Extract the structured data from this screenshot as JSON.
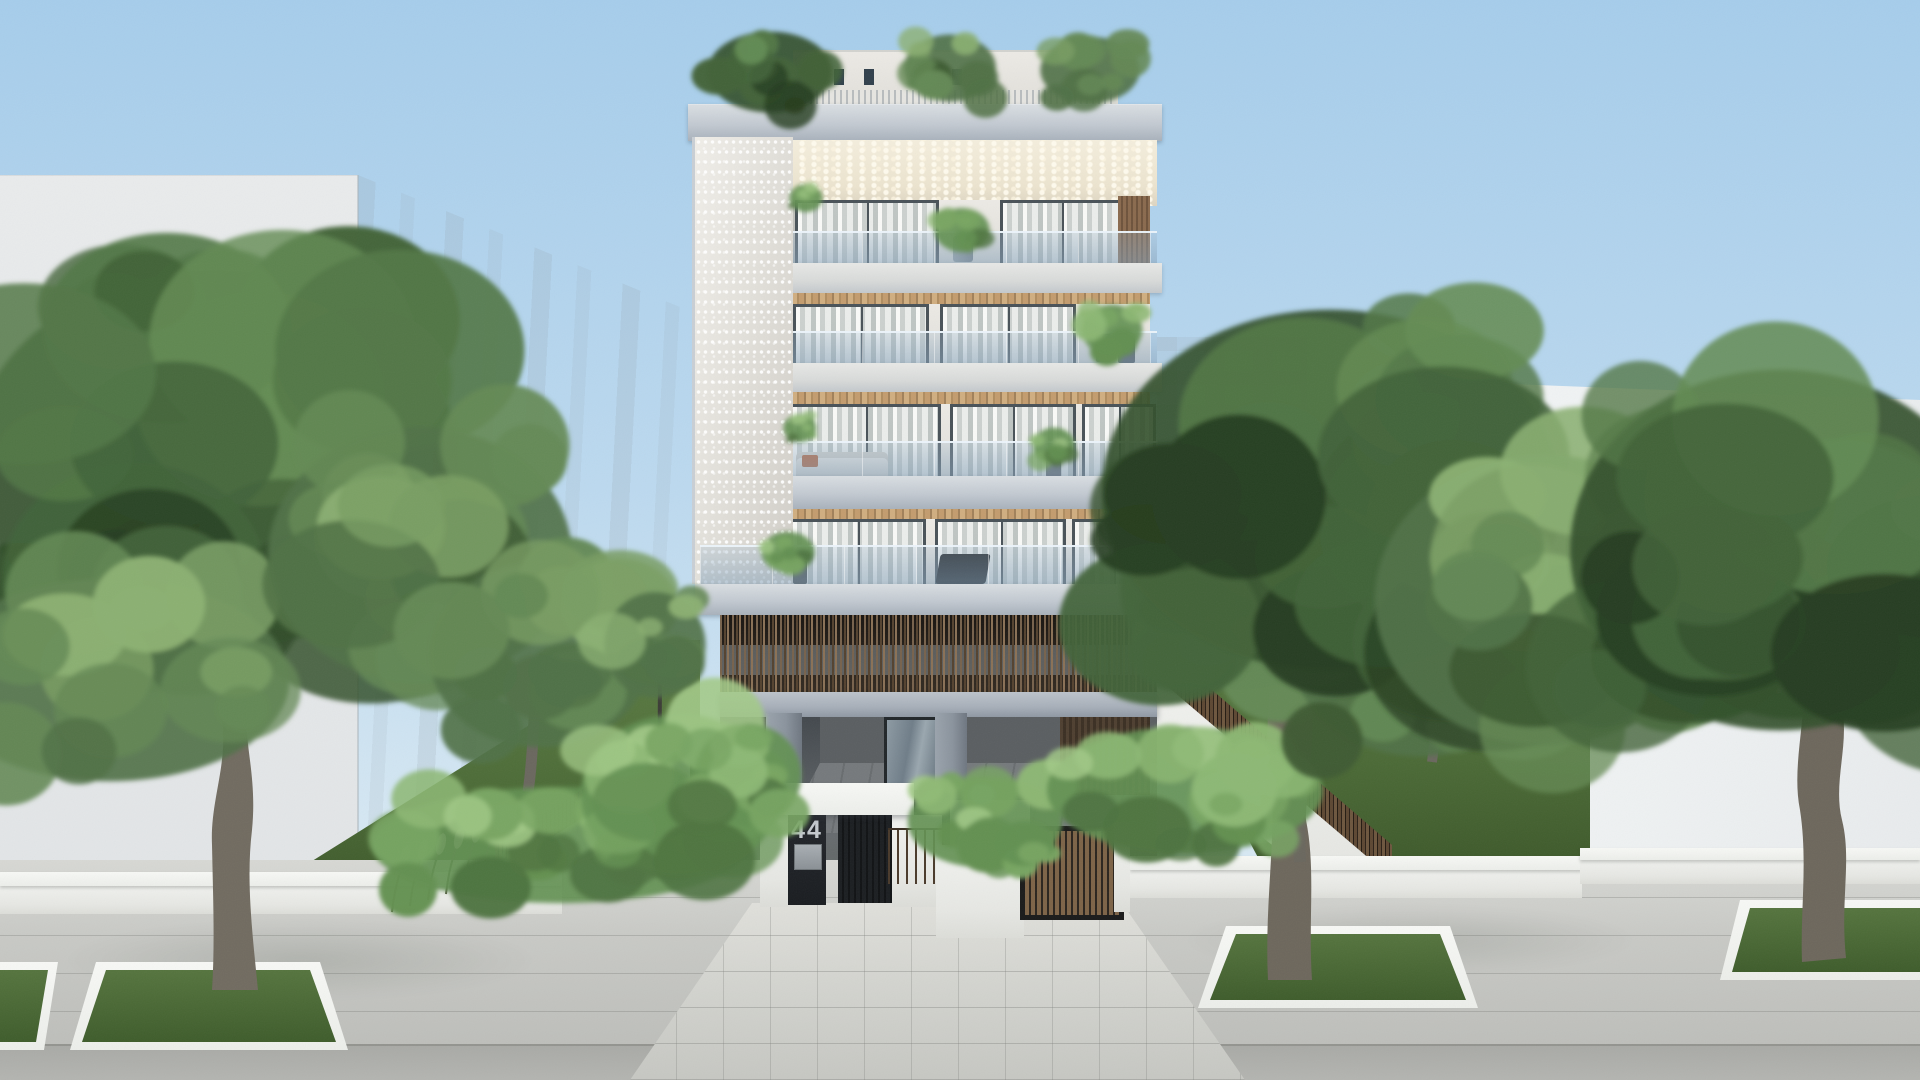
{
  "scene": {
    "type": "architectural-exterior-render",
    "description": "Photorealistic daytime rendering of a modern five-storey white apartment building, street number 44, with perforated concrete side pier, glass balcony balustrades, timber slat screen over the ground-floor pilotis, rooftop garden, lush front gardens with slatted timber fences, and a wide paved sidewalk with street trees in rectangular grass pits.",
    "building": {
      "street_number": "44",
      "floors_visible": 5,
      "features": [
        "rooftop garden with pergola",
        "perforated concrete pier",
        "glass balustrade balconies",
        "sheer curtains behind sliding doors",
        "timber soffits",
        "timber slat ground screen",
        "pilotis parking",
        "entrance portal with number panel and mailbox",
        "timber sliding vehicle gate"
      ]
    },
    "entrance": {
      "number_label": "44"
    },
    "palette": {
      "sky_top": "#a6cdeb",
      "sky_horizon": "#dcebf4",
      "concrete_slab": "#b4bcc6",
      "facade_white": "#eceae5",
      "perforated_wall": "#e3e1db",
      "ceiling_cream": "#efe8d4",
      "soffit_wood": "#c39c6e",
      "slat_wood": "#6d563e",
      "glass_blue": "#a0b8cc",
      "curtain": "#d6dad7",
      "gate_dark": "#17191c",
      "grass": "#4c6b37",
      "foliage_dark": "#31491f",
      "pavement": "#c8c9c5",
      "walkway": "#d5d6d1",
      "trunk": "#6f695e",
      "white_wall": "#eceeea"
    },
    "foliage_palettes": {
      "deep": [
        "#253d20",
        "#33502c",
        "#426339",
        "#527746",
        "#648c54"
      ],
      "mid": [
        "#3d5a32",
        "#507146",
        "#648955",
        "#799d63",
        "#8bb072"
      ],
      "bright": [
        "#4e7340",
        "#639051",
        "#78a562",
        "#8db874",
        "#a2c987"
      ]
    },
    "foliage": [
      {
        "name": "left-street-tree-canopy",
        "x": 215,
        "y": 460,
        "rx": 265,
        "ry": 215,
        "n": 26,
        "palette": "deep",
        "seed": 11
      },
      {
        "name": "left-street-tree-canopy-low",
        "x": 110,
        "y": 680,
        "rx": 195,
        "ry": 115,
        "n": 14,
        "palette": "mid",
        "seed": 12
      },
      {
        "name": "left-canopy-right-lobe",
        "x": 420,
        "y": 555,
        "rx": 165,
        "ry": 145,
        "n": 16,
        "palette": "mid",
        "seed": 13
      },
      {
        "name": "left-slope-olive-canopy",
        "x": 540,
        "y": 655,
        "rx": 120,
        "ry": 105,
        "n": 14,
        "palette": "mid",
        "seed": 14
      },
      {
        "name": "left-garden-shrubs",
        "x": 560,
        "y": 845,
        "rx": 205,
        "ry": 66,
        "n": 22,
        "palette": "bright",
        "seed": 15
      },
      {
        "name": "left-garden-tropical",
        "x": 680,
        "y": 795,
        "rx": 108,
        "ry": 92,
        "n": 16,
        "palette": "bright",
        "seed": 16
      },
      {
        "name": "left-garden-sapling-canopy",
        "x": 655,
        "y": 645,
        "rx": 55,
        "ry": 60,
        "n": 8,
        "palette": "mid",
        "seed": 32
      },
      {
        "name": "entrance-planter-left-plants",
        "x": 748,
        "y": 775,
        "rx": 58,
        "ry": 58,
        "n": 12,
        "palette": "bright",
        "seed": 17
      },
      {
        "name": "entrance-planter-right-plants",
        "x": 985,
        "y": 822,
        "rx": 84,
        "ry": 52,
        "n": 16,
        "palette": "bright",
        "seed": 18
      },
      {
        "name": "right-garden-shrubs",
        "x": 1185,
        "y": 790,
        "rx": 150,
        "ry": 72,
        "n": 18,
        "palette": "bright",
        "seed": 19
      },
      {
        "name": "right-slope-olive-canopy-1",
        "x": 1240,
        "y": 590,
        "rx": 130,
        "ry": 115,
        "n": 14,
        "palette": "mid",
        "seed": 20
      },
      {
        "name": "right-slope-olive-canopy-2",
        "x": 1420,
        "y": 655,
        "rx": 138,
        "ry": 115,
        "n": 14,
        "palette": "mid",
        "seed": 33
      },
      {
        "name": "right-street-tree-canopy",
        "x": 1330,
        "y": 490,
        "rx": 248,
        "ry": 205,
        "n": 26,
        "palette": "deep",
        "seed": 21
      },
      {
        "name": "right-cluster-mid-canopy",
        "x": 1545,
        "y": 600,
        "rx": 185,
        "ry": 165,
        "n": 18,
        "palette": "mid",
        "seed": 22
      },
      {
        "name": "far-right-tree-canopy",
        "x": 1780,
        "y": 550,
        "rx": 228,
        "ry": 205,
        "n": 24,
        "palette": "deep",
        "seed": 23
      },
      {
        "name": "rooftop-plants-left",
        "x": 770,
        "y": 72,
        "rx": 68,
        "ry": 46,
        "n": 12,
        "palette": "deep",
        "seed": 24
      },
      {
        "name": "rooftop-plants-mid",
        "x": 950,
        "y": 68,
        "rx": 50,
        "ry": 38,
        "n": 10,
        "palette": "mid",
        "seed": 25
      },
      {
        "name": "rooftop-plants-right",
        "x": 1090,
        "y": 70,
        "rx": 54,
        "ry": 38,
        "n": 10,
        "palette": "mid",
        "seed": 26
      },
      {
        "name": "balcony5-fern",
        "x": 962,
        "y": 230,
        "rx": 30,
        "ry": 25,
        "n": 8,
        "palette": "bright",
        "seed": 27
      },
      {
        "name": "balcony5-left-plant",
        "x": 806,
        "y": 198,
        "rx": 18,
        "ry": 16,
        "n": 6,
        "palette": "bright",
        "seed": 34
      },
      {
        "name": "balcony4-plants",
        "x": 1112,
        "y": 330,
        "rx": 33,
        "ry": 29,
        "n": 8,
        "palette": "bright",
        "seed": 28
      },
      {
        "name": "balcony3-plant",
        "x": 1054,
        "y": 446,
        "rx": 23,
        "ry": 21,
        "n": 7,
        "palette": "bright",
        "seed": 29
      },
      {
        "name": "balcony3-left-plants",
        "x": 800,
        "y": 428,
        "rx": 18,
        "ry": 16,
        "n": 6,
        "palette": "bright",
        "seed": 31
      },
      {
        "name": "balcony2-plants",
        "x": 788,
        "y": 552,
        "rx": 29,
        "ry": 23,
        "n": 8,
        "palette": "bright",
        "seed": 30
      }
    ]
  }
}
